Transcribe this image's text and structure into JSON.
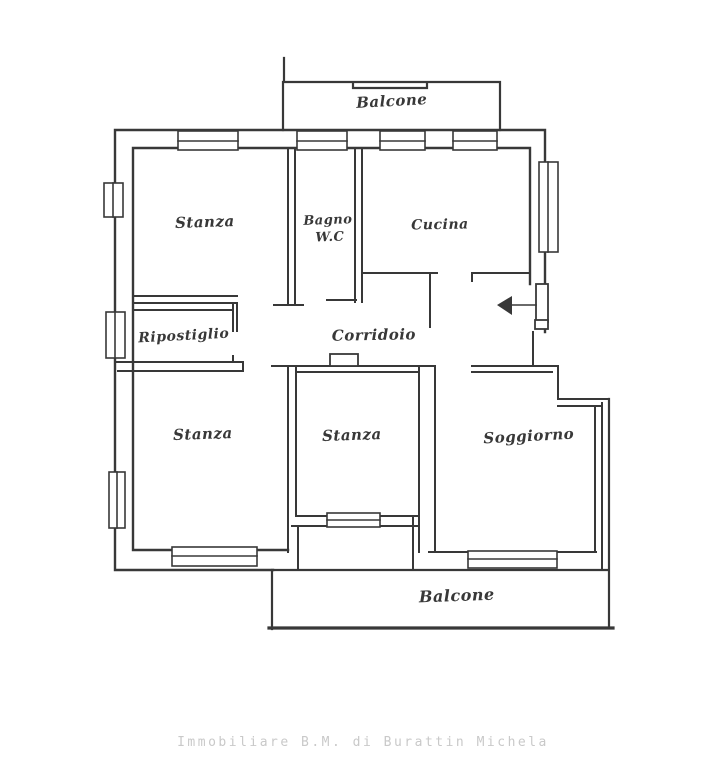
{
  "image": {
    "background": "#ffffff",
    "line_color": "#383838",
    "footer_color": "#c9c9c9"
  },
  "floor_plan": {
    "rooms": {
      "balcone_top": {
        "label": "Balcone"
      },
      "stanza_nw": {
        "label": "Stanza"
      },
      "bagno": {
        "label_line1": "Bagno",
        "label_line2": "W.C"
      },
      "cucina": {
        "label": "Cucina"
      },
      "ripostiglio": {
        "label": "Ripostiglio"
      },
      "corridoio": {
        "label": "Corridoio"
      },
      "stanza_sw": {
        "label": "Stanza"
      },
      "stanza_s": {
        "label": "Stanza"
      },
      "soggiorno": {
        "label": "Soggiorno"
      },
      "balcone_bottom": {
        "label": "Balcone"
      }
    },
    "entrance_icon": "entrance-arrow"
  },
  "footer": {
    "text": "Immobiliare B.M. di Burattin Michela"
  }
}
